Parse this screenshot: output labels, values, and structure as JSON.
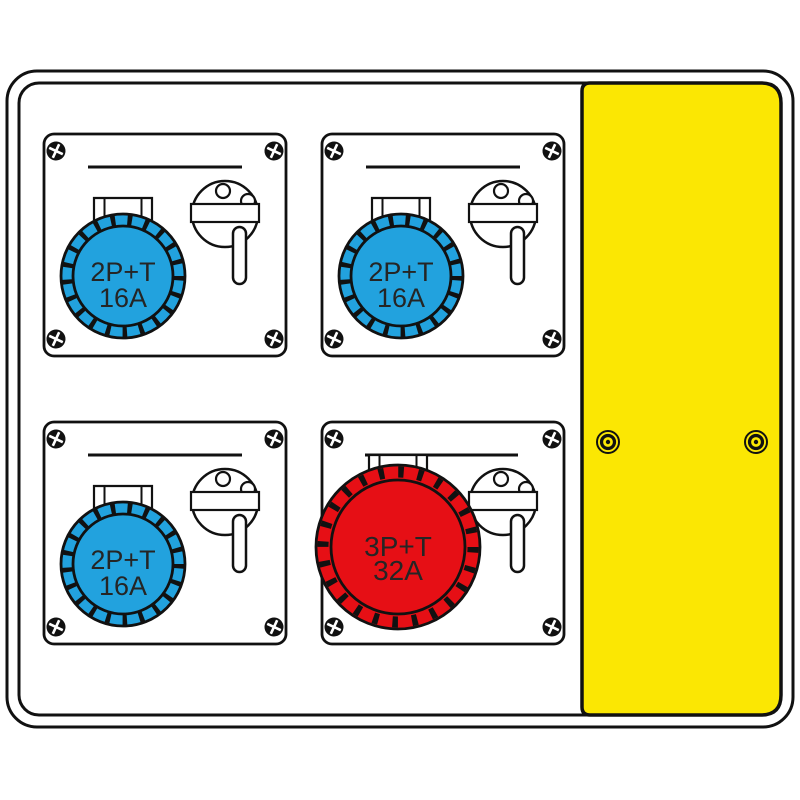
{
  "illustration": {
    "colors": {
      "outline": "#111111",
      "background": "#ffffff",
      "door_yellow": "#FBE703",
      "socket_blue": "#22A2DE",
      "socket_red": "#E60F15"
    },
    "door": {
      "fastener_count": "2"
    },
    "modules": [
      {
        "position": "top-left",
        "socket_label_line1": "2P+T",
        "socket_label_line2": "16A",
        "socket_color": "#22A2DE"
      },
      {
        "position": "top-right",
        "socket_label_line1": "2P+T",
        "socket_label_line2": "16A",
        "socket_color": "#22A2DE"
      },
      {
        "position": "bottom-left",
        "socket_label_line1": "2P+T",
        "socket_label_line2": "16A",
        "socket_color": "#22A2DE"
      },
      {
        "position": "bottom-right",
        "socket_label_line1": "3P+T",
        "socket_label_line2": "32A",
        "socket_color": "#E60F15"
      }
    ]
  }
}
